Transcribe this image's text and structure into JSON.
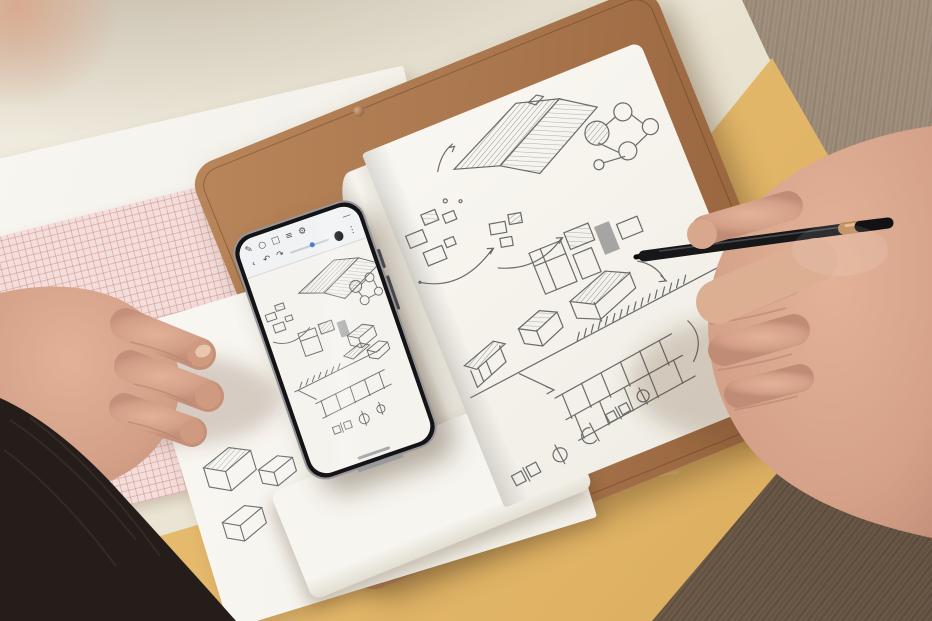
{
  "scene": {
    "objects": [
      "rolled-paper",
      "wood-desk",
      "manila-envelope",
      "leather-notebook",
      "notebook-sketch-page",
      "white-paper-pad",
      "sketch-sheet",
      "pink-grid-paper",
      "smartphone-sketch-app",
      "stylus-pen",
      "right-hand",
      "left-hand",
      "hair",
      "white-clothing"
    ]
  },
  "colors": {
    "desk_wood_light": "#92806d",
    "desk_wood_dark": "#6e5947",
    "paper_roll_cream": "#e9e3d2",
    "envelope_yellow": "#e6bb6e",
    "notebook_leather_tan": "#a9764e",
    "page_white": "#f6f4ee",
    "pencil_gray": "#6a6a6a",
    "grid_paper_pink": "#f3dedc",
    "grid_line_pink": "#d9a8a4",
    "phone_body_black": "#141416",
    "phone_screen_white": "#f4f3ee",
    "slider_blue": "#4a7fd0",
    "stylus_black": "#17171a",
    "stylus_copper_ring": "#c08a5d",
    "skin_tone": "#d8a78e",
    "hair_dark_brown": "#241d19",
    "clothing_white": "#f2efe8"
  },
  "phone": {
    "toolbar": {
      "tools_row": [
        {
          "name": "pen-icon",
          "glyph": "✎"
        },
        {
          "name": "lasso-icon",
          "glyph": "○"
        },
        {
          "name": "eraser-icon",
          "glyph": "□"
        },
        {
          "name": "layers-icon",
          "glyph": "≡"
        },
        {
          "name": "settings-icon",
          "glyph": "⚙"
        },
        {
          "name": "minimize-icon",
          "glyph": "—"
        }
      ],
      "nav_row": [
        {
          "name": "back-icon",
          "glyph": "‹"
        },
        {
          "name": "undo-icon",
          "glyph": "↶"
        },
        {
          "name": "redo-icon",
          "glyph": "↷"
        }
      ],
      "stroke_slider": {
        "name": "stroke-size-slider",
        "value_pct": 55,
        "track_color": "#c9cdd3",
        "fill_color": "#4a7fd0"
      },
      "selected_color_swatch": {
        "name": "color-swatch-black",
        "hex": "#141414"
      },
      "more": {
        "name": "more-icon",
        "glyph": "⋮"
      }
    }
  }
}
